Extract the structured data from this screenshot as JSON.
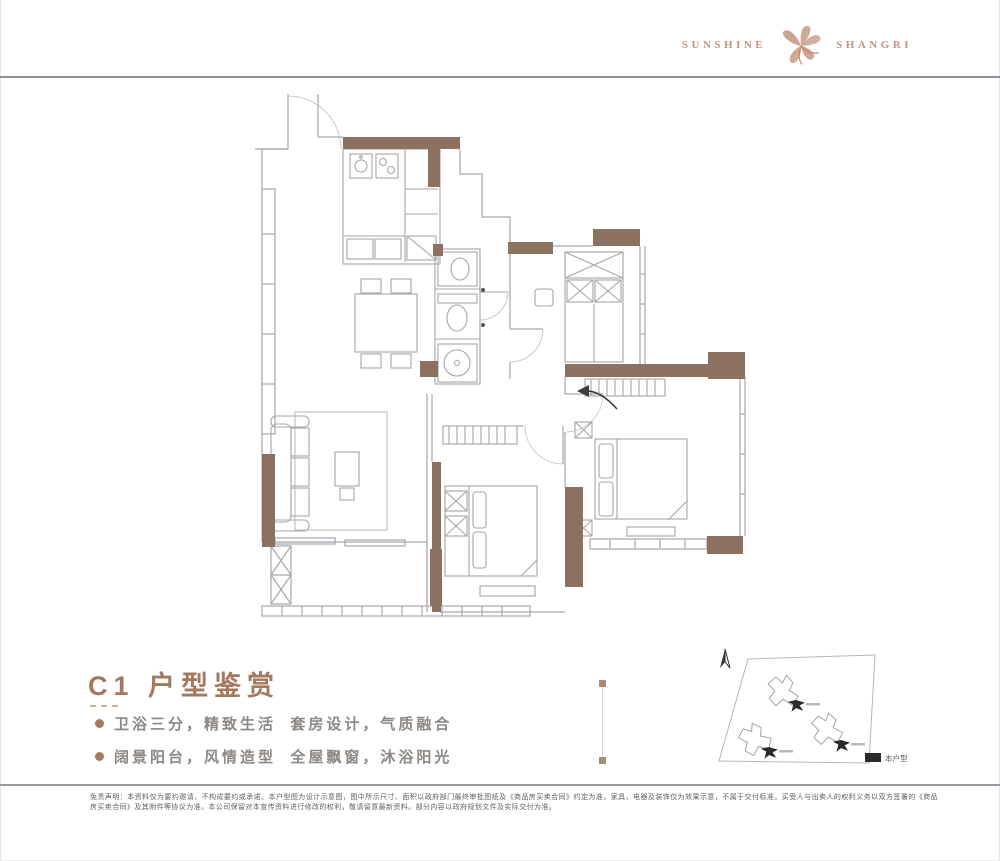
{
  "header": {
    "brand_left": "SUNSHINE",
    "brand_right": "SHANGRI"
  },
  "content": {
    "title": "C1 户型鉴赏",
    "bullets": [
      {
        "text": "卫浴三分，精致生活  套房设计，气质融合"
      },
      {
        "text": "阔景阳台，风情造型  全屋飘窗，沐浴阳光"
      }
    ]
  },
  "sitemap": {
    "legend": "本户型"
  },
  "footer": {
    "disclaimer": "免责声明：本资料仅为要约邀请，不构成要约或承诺。本户型图为设计示意图，图中所示尺寸、面积以政府部门最终审批图纸及《商品房买卖合同》约定为准，家具、电器及装饰仅为效果示意，不属于交付标准。买受人与出卖人的权利义务以双方签署的《商品房买卖合同》及其附件等协议为准。本公司保留对本宣传资料进行修改的权利，敬请留意最新资料。部分内容以政府规划文件及实际交付为准。"
  },
  "colors": {
    "wall_brown": "#8d7160",
    "accent_brown": "#a3785c",
    "logo_tan": "#c1937c",
    "line_gray": "#a6a6ad",
    "rule_gray": "#8e8e98",
    "marker_black": "#2a2a2a"
  }
}
